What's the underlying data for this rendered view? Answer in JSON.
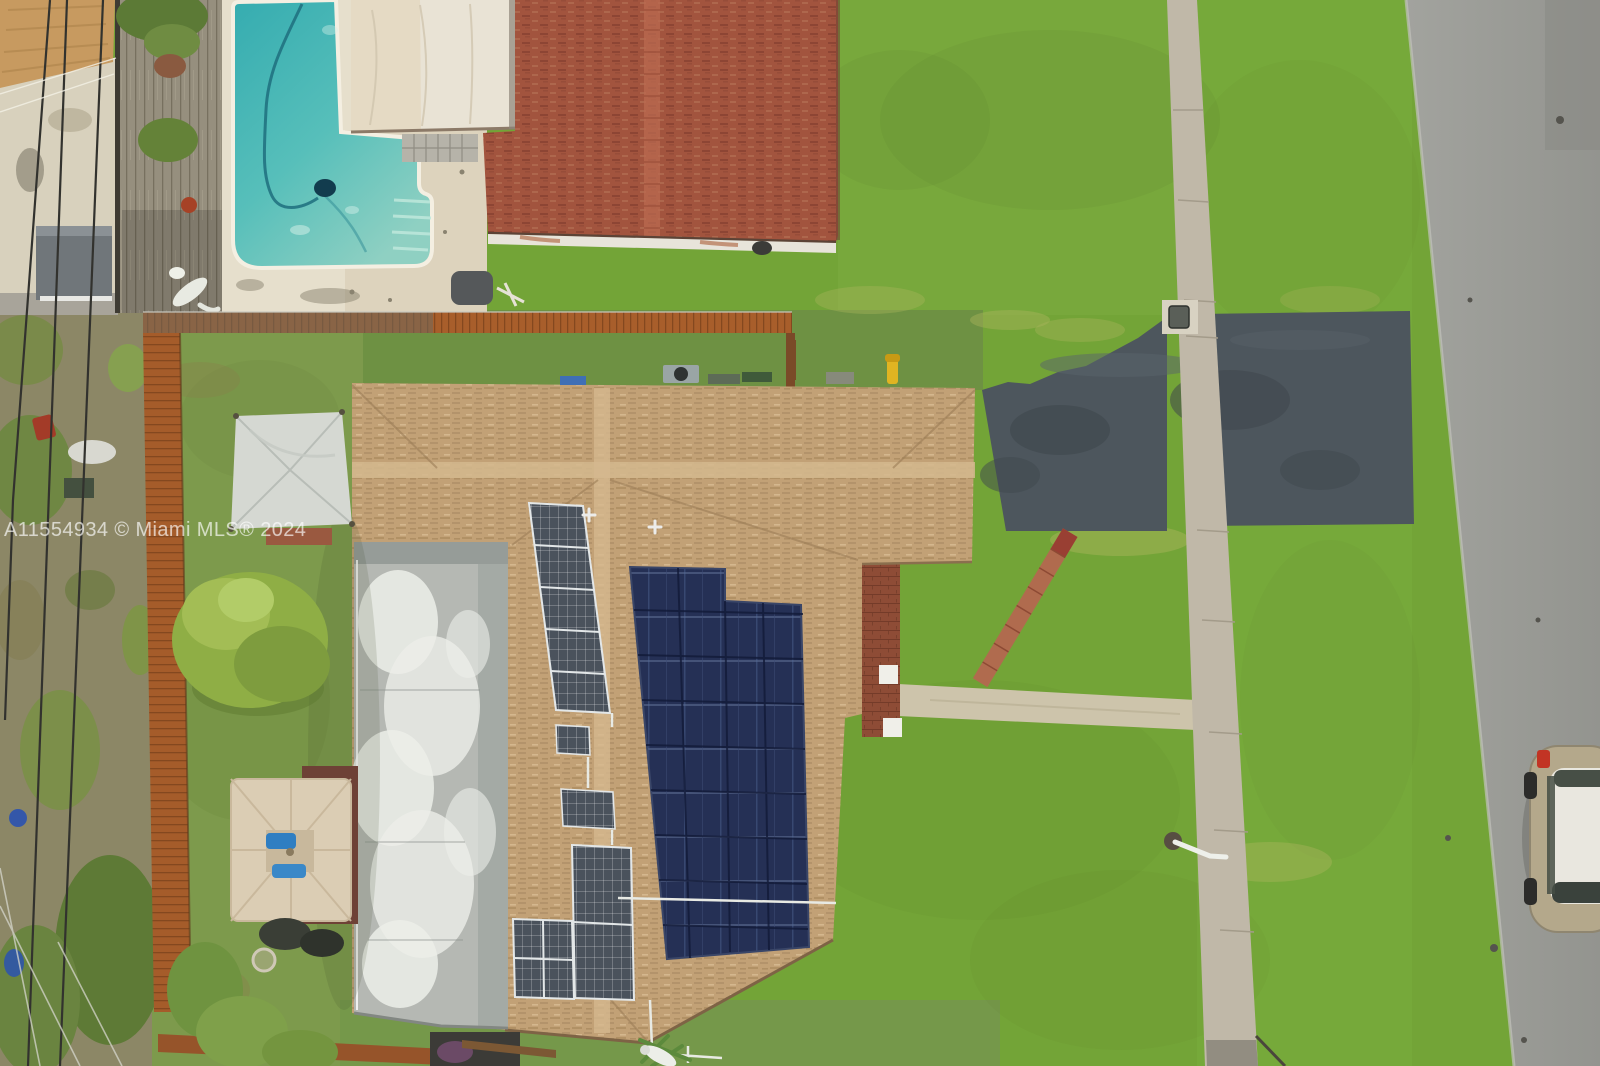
{
  "meta": {
    "type": "aerial-drone-photograph",
    "description": "Top-down aerial real-estate photo of a single-family house with a tan shingle roof and rooftop solar panels; neighboring pool and red-roof house above, backyard with patio umbrella left, front lawn with concrete sidewalk, fresh asphalt driveway and street on the right, one car on the street",
    "width_px": 1600,
    "height_px": 1066
  },
  "watermark": {
    "text": "A11554934 © Miami MLS® 2024",
    "color": "#ffffff",
    "opacity": 0.62
  },
  "scene_objects": [
    "main-house-shingle-roof",
    "flat-white-roof-section",
    "solar-panel-array-dark",
    "solar-panel-column-light",
    "roof-ridge-caps",
    "roof-vents",
    "neighbor-pool",
    "pool-vacuum-hose",
    "pool-deck",
    "wood-plank-deck",
    "alligator-statue",
    "neighbor-white-roof",
    "neighbor-red-shingle-roof",
    "rust-wood-fence",
    "backyard-lawn",
    "patio-umbrella-tan",
    "silver-tarp-canopy",
    "yellow-green-tree",
    "front-lawn",
    "concrete-sidewalk",
    "asphalt-driveway",
    "street",
    "parked-car",
    "brick-patio",
    "paver-path-diagonal",
    "concrete-walkway",
    "utility-marker-box",
    "power-lines",
    "hvac-unit",
    "yellow-utility-pole",
    "sprinkler-pipe",
    "gray-shed",
    "watermark-text"
  ],
  "palette": {
    "lawn_green": "#73a437",
    "backyard_olive": "#7d9a4c",
    "scrub_ground": "#8c8766",
    "pool_water": "#45b7b4",
    "pool_deck_sand": "#e6dfcc",
    "tan_roof": "#c2a176",
    "red_roof": "#a2543e",
    "white_flat_roof": "#b5b8b3",
    "solar_dark": "#253055",
    "solar_light": "#4a525c",
    "driveway_asphalt": "#4d565d",
    "sidewalk_concrete": "#c0b8a8",
    "street_asphalt": "#9b9c97",
    "fence_rust": "#a85e2b",
    "brick_patio": "#8e4c36",
    "umbrella_tan": "#dbcdb4",
    "car_body_tan": "#b4a88b",
    "car_roof_white": "#e9e7df"
  }
}
